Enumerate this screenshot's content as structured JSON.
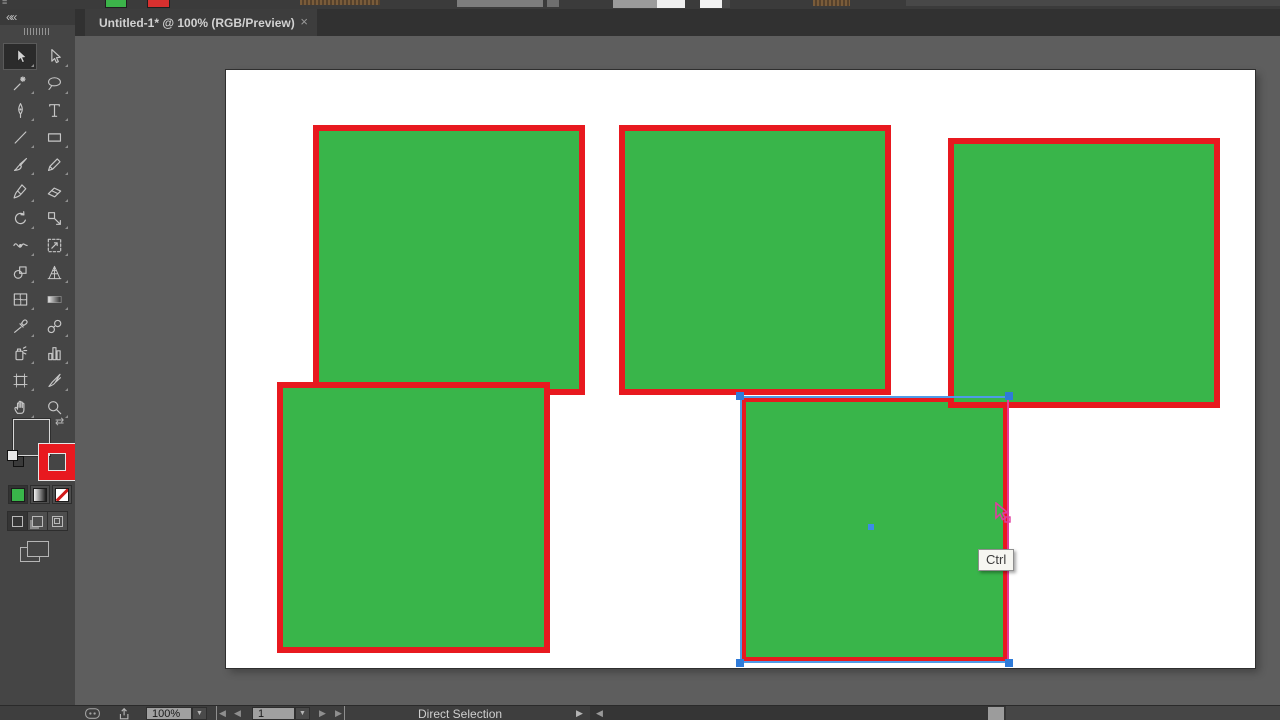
{
  "window": {
    "menu_hint": "≡",
    "collapse_arrows": "««",
    "tab": {
      "title": "Untitled-1* @ 100% (RGB/Preview)",
      "close": "×"
    }
  },
  "toolbar": {
    "active_tool": "selection",
    "tools": [
      [
        "selection",
        "direct-selection"
      ],
      [
        "magic-wand",
        "lasso"
      ],
      [
        "pen",
        "type"
      ],
      [
        "line-segment",
        "rectangle"
      ],
      [
        "paintbrush",
        "pencil"
      ],
      [
        "blob-brush",
        "eraser"
      ],
      [
        "rotate",
        "scale"
      ],
      [
        "width",
        "free-transform"
      ],
      [
        "shape-builder",
        "perspective-grid"
      ],
      [
        "mesh",
        "gradient"
      ],
      [
        "eyedropper",
        "blend"
      ],
      [
        "symbol-sprayer",
        "column-graph"
      ],
      [
        "artboard",
        "slice"
      ],
      [
        "hand",
        "zoom"
      ]
    ],
    "fill_color": "#39B54A",
    "stroke_color": "#E8191F",
    "swap_icon": "⇄",
    "active_mode": "color",
    "active_draw_mode": "draw-normal"
  },
  "canvas": {
    "pasteboard_color": "#5e5e5e",
    "artboard": {
      "x": 226,
      "y": 70,
      "w": 1029,
      "h": 598,
      "color": "#FFFFFF"
    }
  },
  "shapes": [
    {
      "name": "green-rect-top-left",
      "x": 313,
      "y": 125,
      "w": 272,
      "h": 270,
      "fill": "#39B54A",
      "stroke": "#E8191F",
      "stroke_width": 6,
      "selected": false
    },
    {
      "name": "green-rect-top-middle",
      "x": 619,
      "y": 125,
      "w": 272,
      "h": 270,
      "fill": "#39B54A",
      "stroke": "#E8191F",
      "stroke_width": 6,
      "selected": false
    },
    {
      "name": "green-rect-bottom-left",
      "x": 277,
      "y": 382,
      "w": 273,
      "h": 271,
      "fill": "#39B54A",
      "stroke": "#E8191F",
      "stroke_width": 6,
      "selected": false
    },
    {
      "name": "green-rect-bottom-middle",
      "x": 740,
      "y": 396,
      "w": 269,
      "h": 267,
      "fill": "#39B54A",
      "stroke": "#E8191F",
      "stroke_width": 6,
      "selected": true
    },
    {
      "name": "green-rect-top-right",
      "x": 948,
      "y": 138,
      "w": 272,
      "h": 270,
      "fill": "#39B54A",
      "stroke": "#E8191F",
      "stroke_width": 6,
      "selected": false
    }
  ],
  "selection": {
    "outline_color": "#4E9BE8",
    "anchor_color": "#2F7BD9",
    "guide_color": "#E6399B",
    "center_x": 871,
    "center_y": 527
  },
  "cursor": {
    "x": 992,
    "y": 502,
    "color": "#E03DA0"
  },
  "tooltip": {
    "text": "Ctrl",
    "x": 978,
    "y": 549
  },
  "status_bar": {
    "zoom_value": "100%",
    "artboard_value": "1",
    "dropdown_arrow": "▼",
    "nav_first": "◀",
    "nav_prev": "◀",
    "nav_next": "▶",
    "nav_last": "▶",
    "tool_status": "Direct Selection",
    "expand_arrow": "▶",
    "scroll_left_arrow": "◀"
  }
}
